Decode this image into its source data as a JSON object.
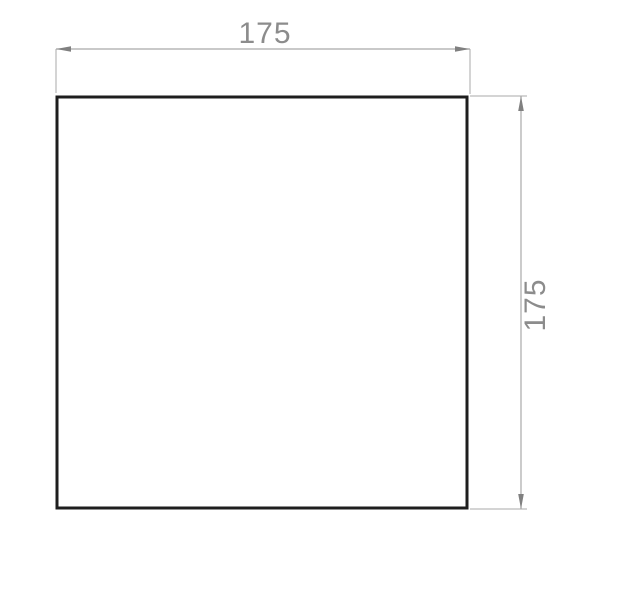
{
  "drawing": {
    "shape": "square",
    "dimensions": {
      "width_label": "175",
      "height_label": "175"
    },
    "colors": {
      "outline": "#1e1e1e",
      "dimension_line": "#a9a9a9",
      "arrowhead": "#808080",
      "dimension_text": "#8c8c8c",
      "background": "#ffffff"
    }
  }
}
